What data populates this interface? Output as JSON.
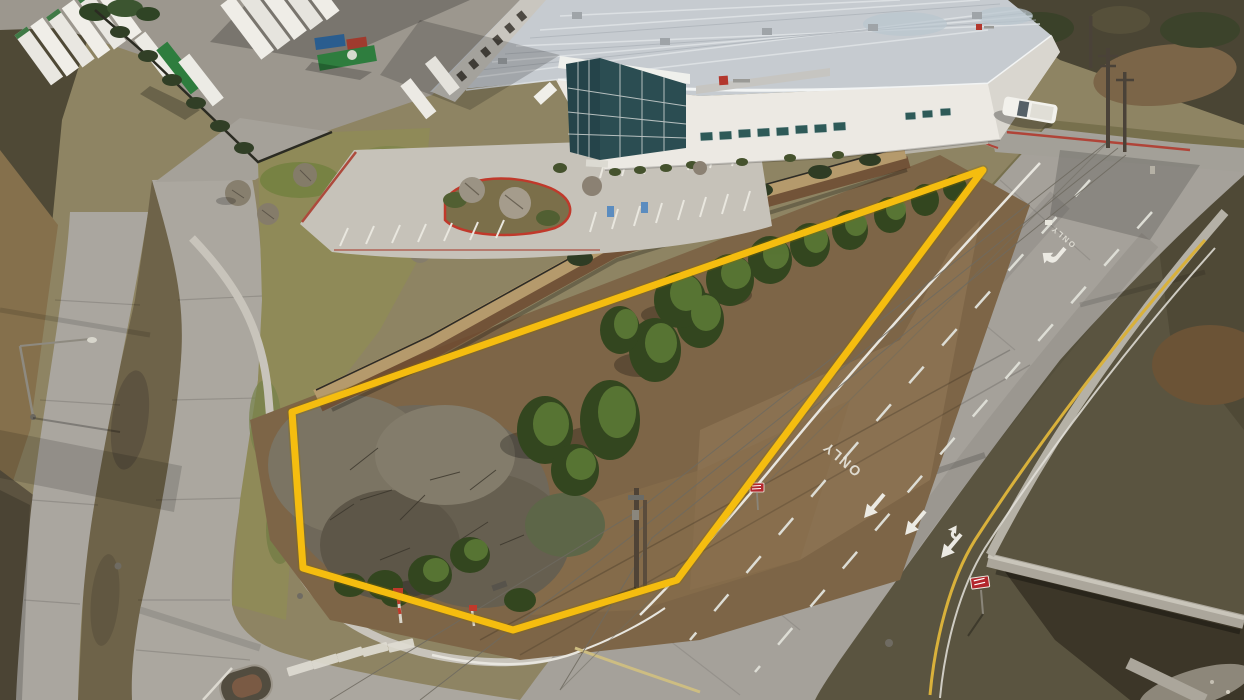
{
  "image": {
    "kind": "aerial-drone-photograph",
    "subject": "vacant corner land parcel outlined in yellow beside a warehouse distribution facility, bordered by curving concrete roads",
    "boundary_color": "#F5BD0F"
  },
  "markings": {
    "lane_word": "ONLY"
  },
  "signs": {
    "wrong_way_color": "#B3272D"
  },
  "vehicles": {
    "trailer_green": "#2E7D3E",
    "container_blue": "#2A5D8F",
    "container_red": "#A03B2E",
    "pickup_white": "#F2F1EC"
  }
}
